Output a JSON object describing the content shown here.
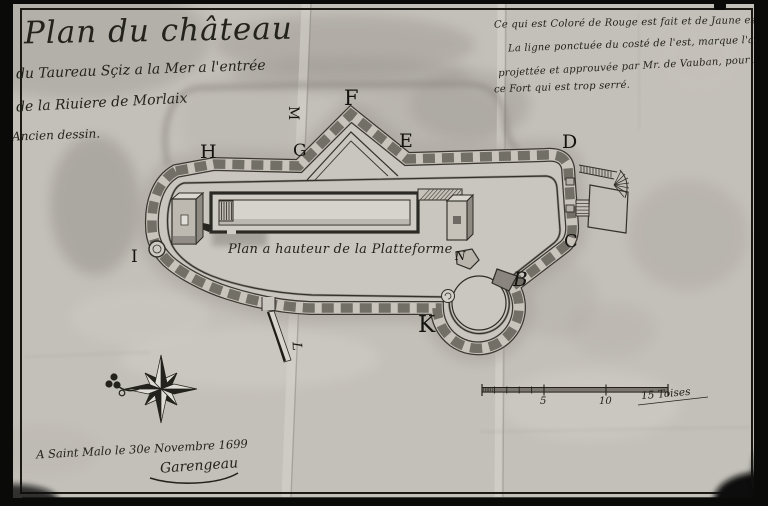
{
  "document": {
    "title_line1": "Plan du château",
    "title_line2": "du Taureau Sçiz a la Mer a l'entrée",
    "title_line3": "de la Riuiere de Morlaix",
    "title_note": "Ancien dessin.",
    "legend_line1": "Ce qui est Coloré de Rouge est fait et de Jaune est a faire.",
    "legend_line2": "La ligne ponctuée du costé de l'est, marque l'augmentation",
    "legend_line3": "projettée et approuvée par Mr. de Vauban, pour Rectifier —",
    "legend_line4": "ce Fort qui est trop serré.",
    "plan_caption": "Plan a hauteur de la Platteforme",
    "date_line": "A Saint Malo le 30e Novembre 1699",
    "signature": "Garengeau"
  },
  "markers": {
    "h": "H",
    "g": "G",
    "f": "F",
    "e": "E",
    "d": "D",
    "c": "C",
    "b": "B",
    "k": "K",
    "i": "I",
    "l": "L",
    "m": "M",
    "n": "N"
  },
  "scale_bar": {
    "five": "5",
    "ten": "10",
    "fifteen": "15 Toises"
  },
  "colors": {
    "ink": "#23221c",
    "paper": "#c3c0b9",
    "wall_block": "#6e6a62",
    "wash": "#a39f98"
  }
}
